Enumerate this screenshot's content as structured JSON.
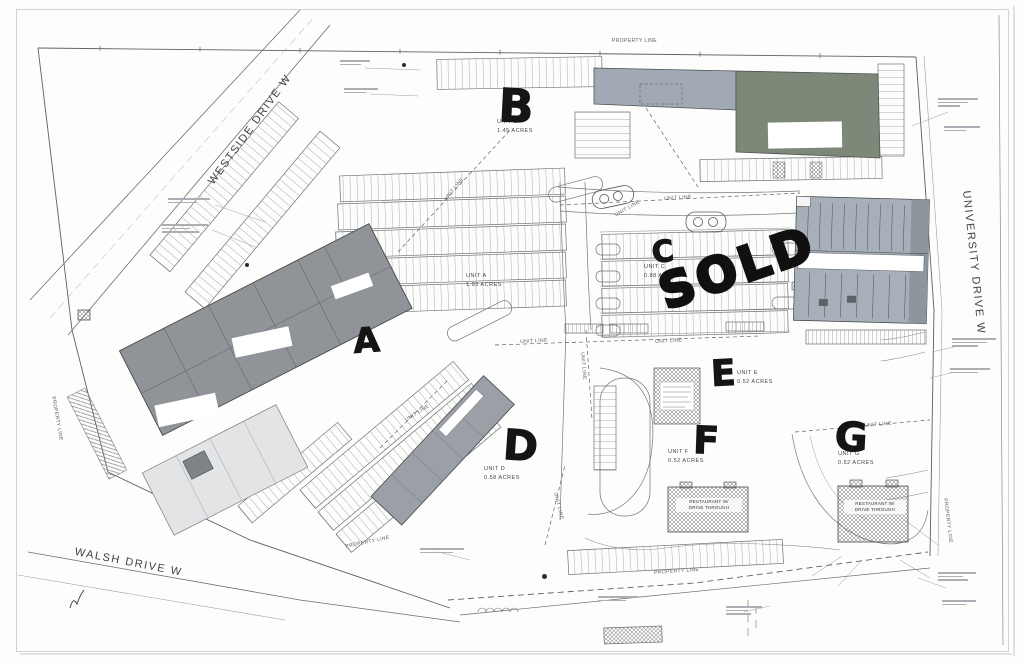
{
  "plan": {
    "streets": {
      "westside": "WESTSIDE DRIVE W",
      "university": "UNIVERSITY DRIVE W",
      "walsh": "WALSH DRIVE W"
    },
    "labels": {
      "property_line": "PROPERTY LINE",
      "unit_line": "UNIT LINE"
    },
    "handwritten": {
      "sold": "SOLD"
    },
    "units": [
      {
        "letter": "A",
        "name": "UNIT A",
        "acres": "1.93 ACRES"
      },
      {
        "letter": "B",
        "name": "UNIT B",
        "acres": "1.45 ACRES"
      },
      {
        "letter": "C",
        "name": "UNIT C",
        "acres": "0.88 ACRES"
      },
      {
        "letter": "D",
        "name": "UNIT D",
        "acres": "0.58 ACRES"
      },
      {
        "letter": "E",
        "name": "UNIT E",
        "acres": "0.52 ACRES"
      },
      {
        "letter": "F",
        "name": "UNIT F",
        "acres": "0.52 ACRES"
      },
      {
        "letter": "G",
        "name": "UNIT G",
        "acres": "0.52 ACRES"
      }
    ],
    "pads": {
      "restaurant_center": {
        "line1": "RESTAURANT W/",
        "line2": "DRIVE THROUGH"
      },
      "restaurant_east": {
        "line1": "RESTAURANT W/",
        "line2": "DRIVE THROUGH"
      }
    }
  }
}
